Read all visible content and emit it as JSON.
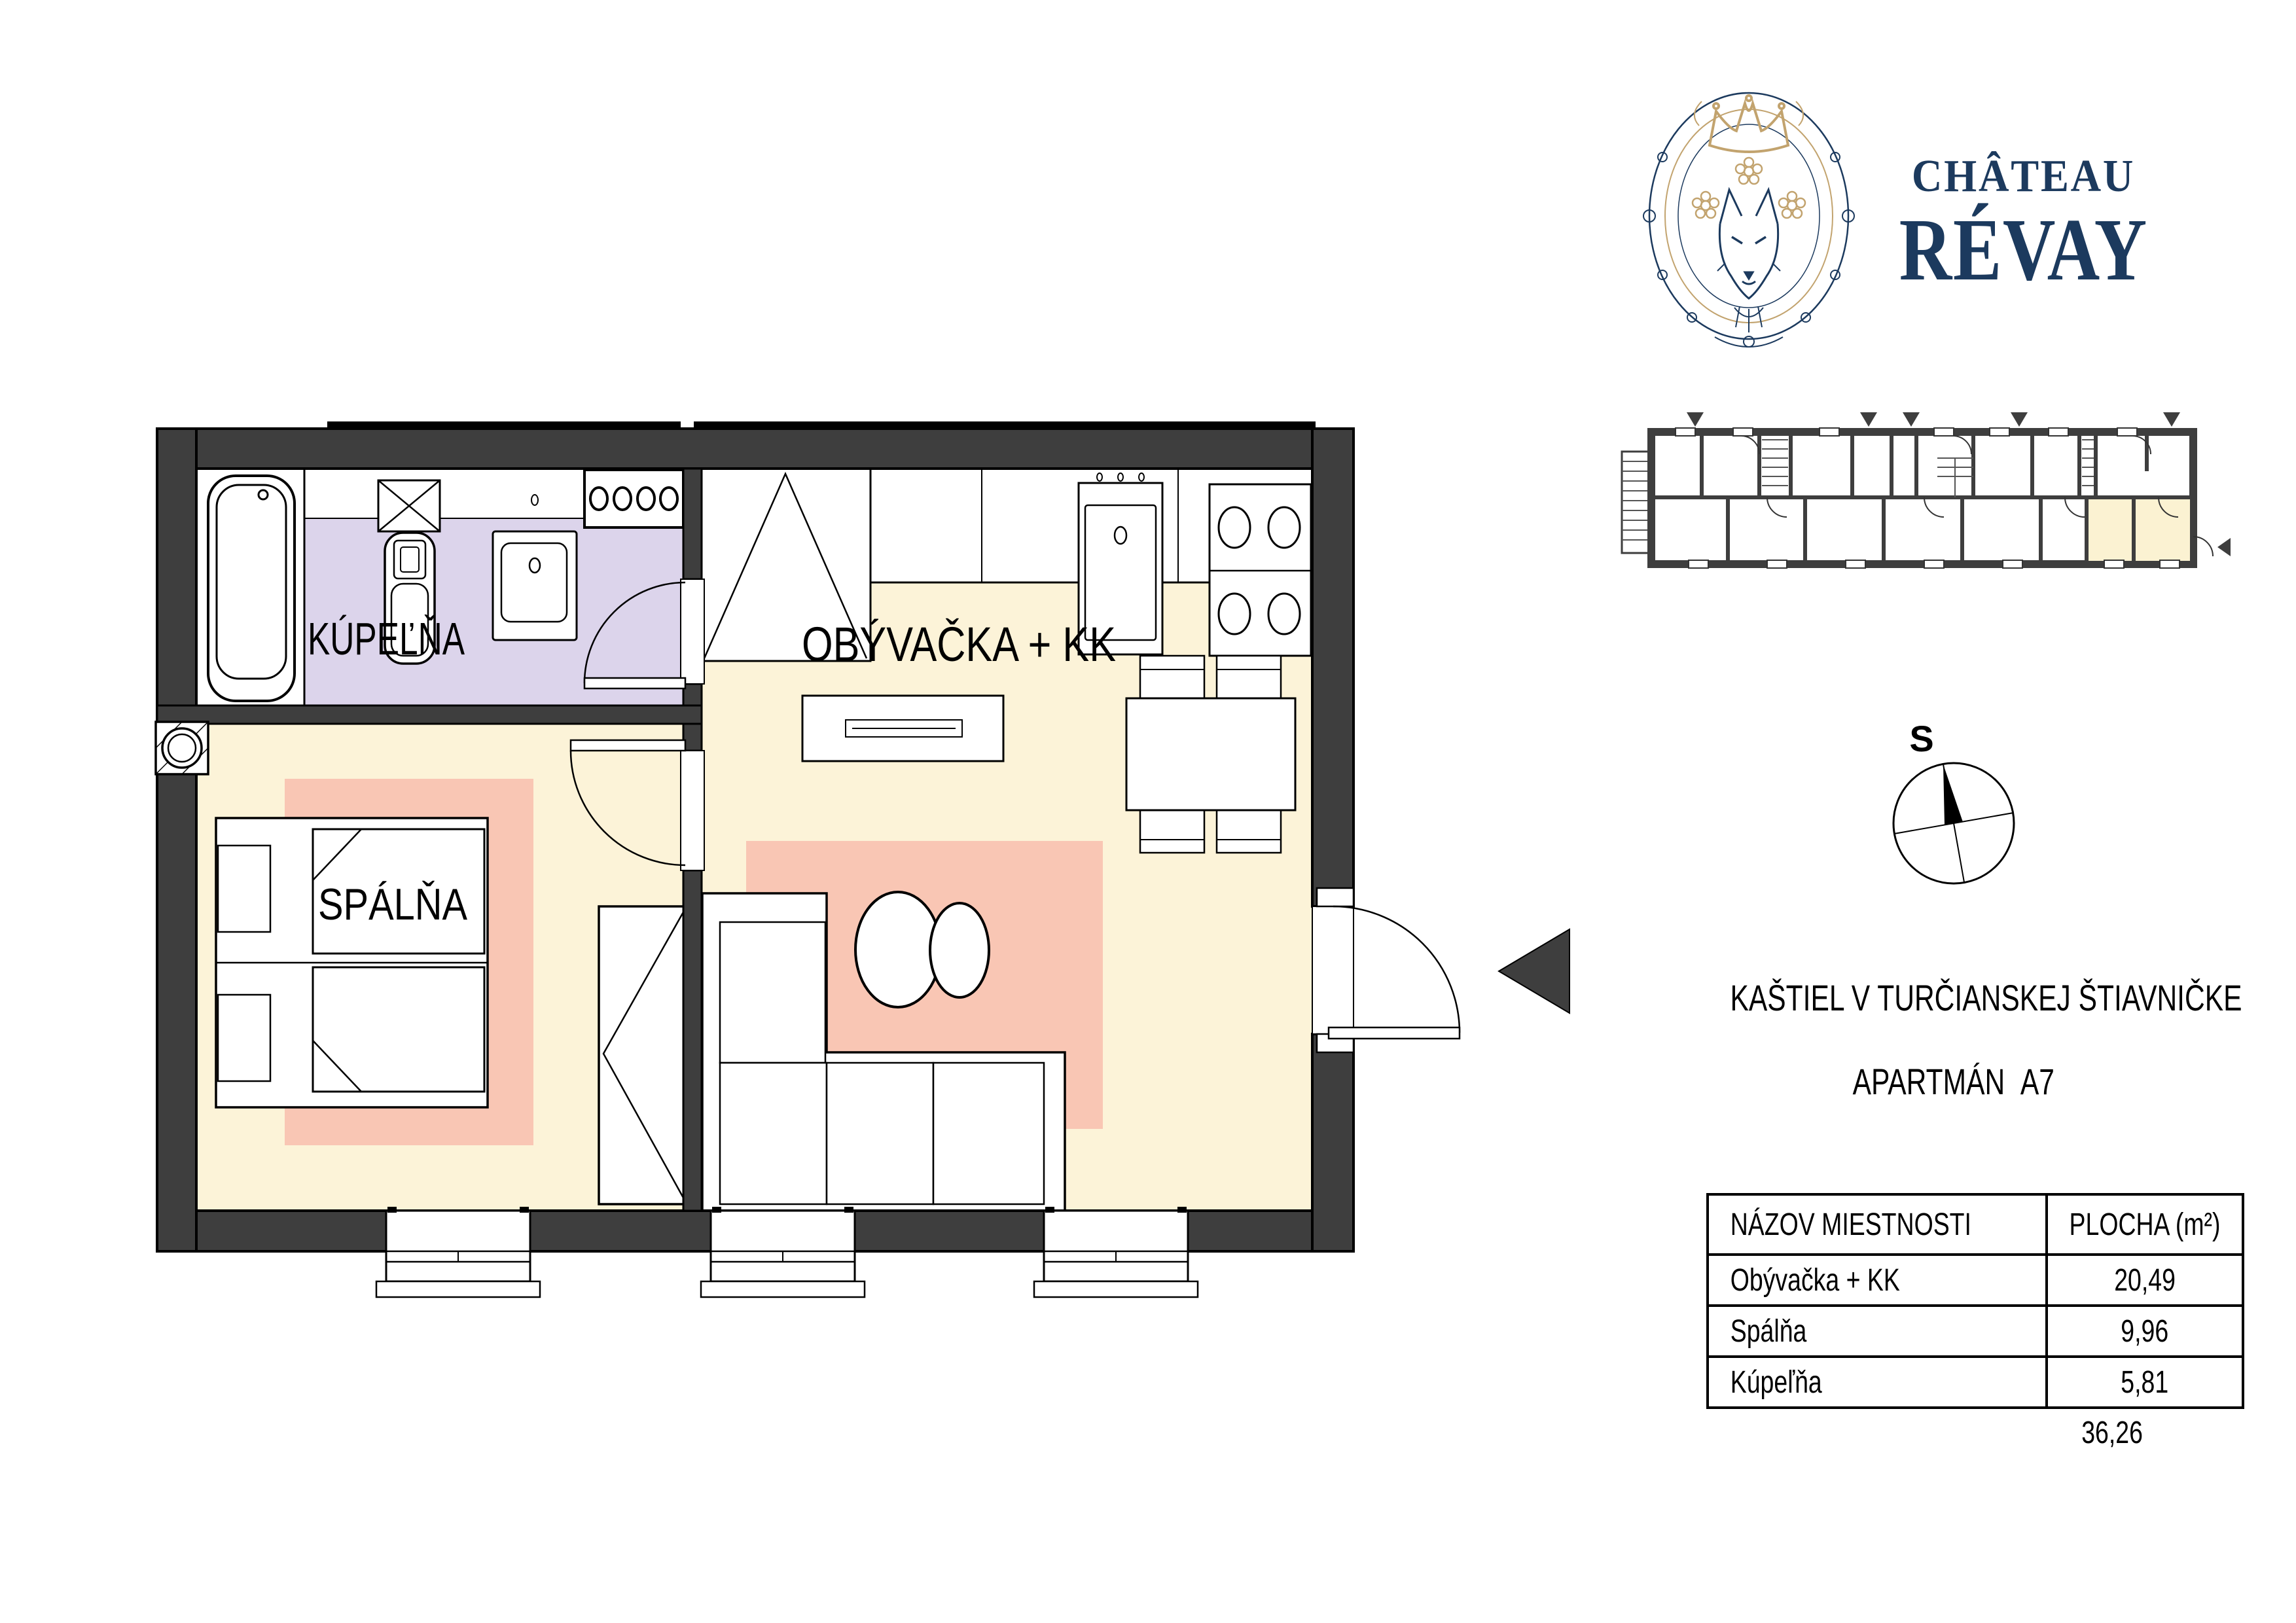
{
  "brand": {
    "line1": "CHÂTEAU",
    "line2": "RÉVAY",
    "navy": "#1c3a5e",
    "gold": "#c2a36e"
  },
  "project": {
    "title": "KAŠTIEL V TURČIANSKEJ ŠTIAVNIČKE",
    "subtitle": "APARTMÁN  A7"
  },
  "compass": {
    "north_label": "S"
  },
  "plan": {
    "rooms": {
      "bathroom": "KÚPEĽŇA",
      "living": "OBÝVAČKA + KK",
      "bedroom": "SPÁLŇA"
    },
    "colors": {
      "wall": "#3e3e3e",
      "bathroom_floor": "#dcd4eb",
      "apartment_floor": "#fcf3d8",
      "rug": "#f9c6b4",
      "overview_highlight": "#fbf2d2"
    }
  },
  "area_table": {
    "headers": [
      "NÁZOV MIESTNOSTI",
      "PLOCHA (m²)"
    ],
    "rows": [
      {
        "name": "Obývačka + KK",
        "area": "20,49"
      },
      {
        "name": "Spálňa",
        "area": "9,96"
      },
      {
        "name": "Kúpeľňa",
        "area": "5,81"
      }
    ],
    "total": "36,26"
  }
}
